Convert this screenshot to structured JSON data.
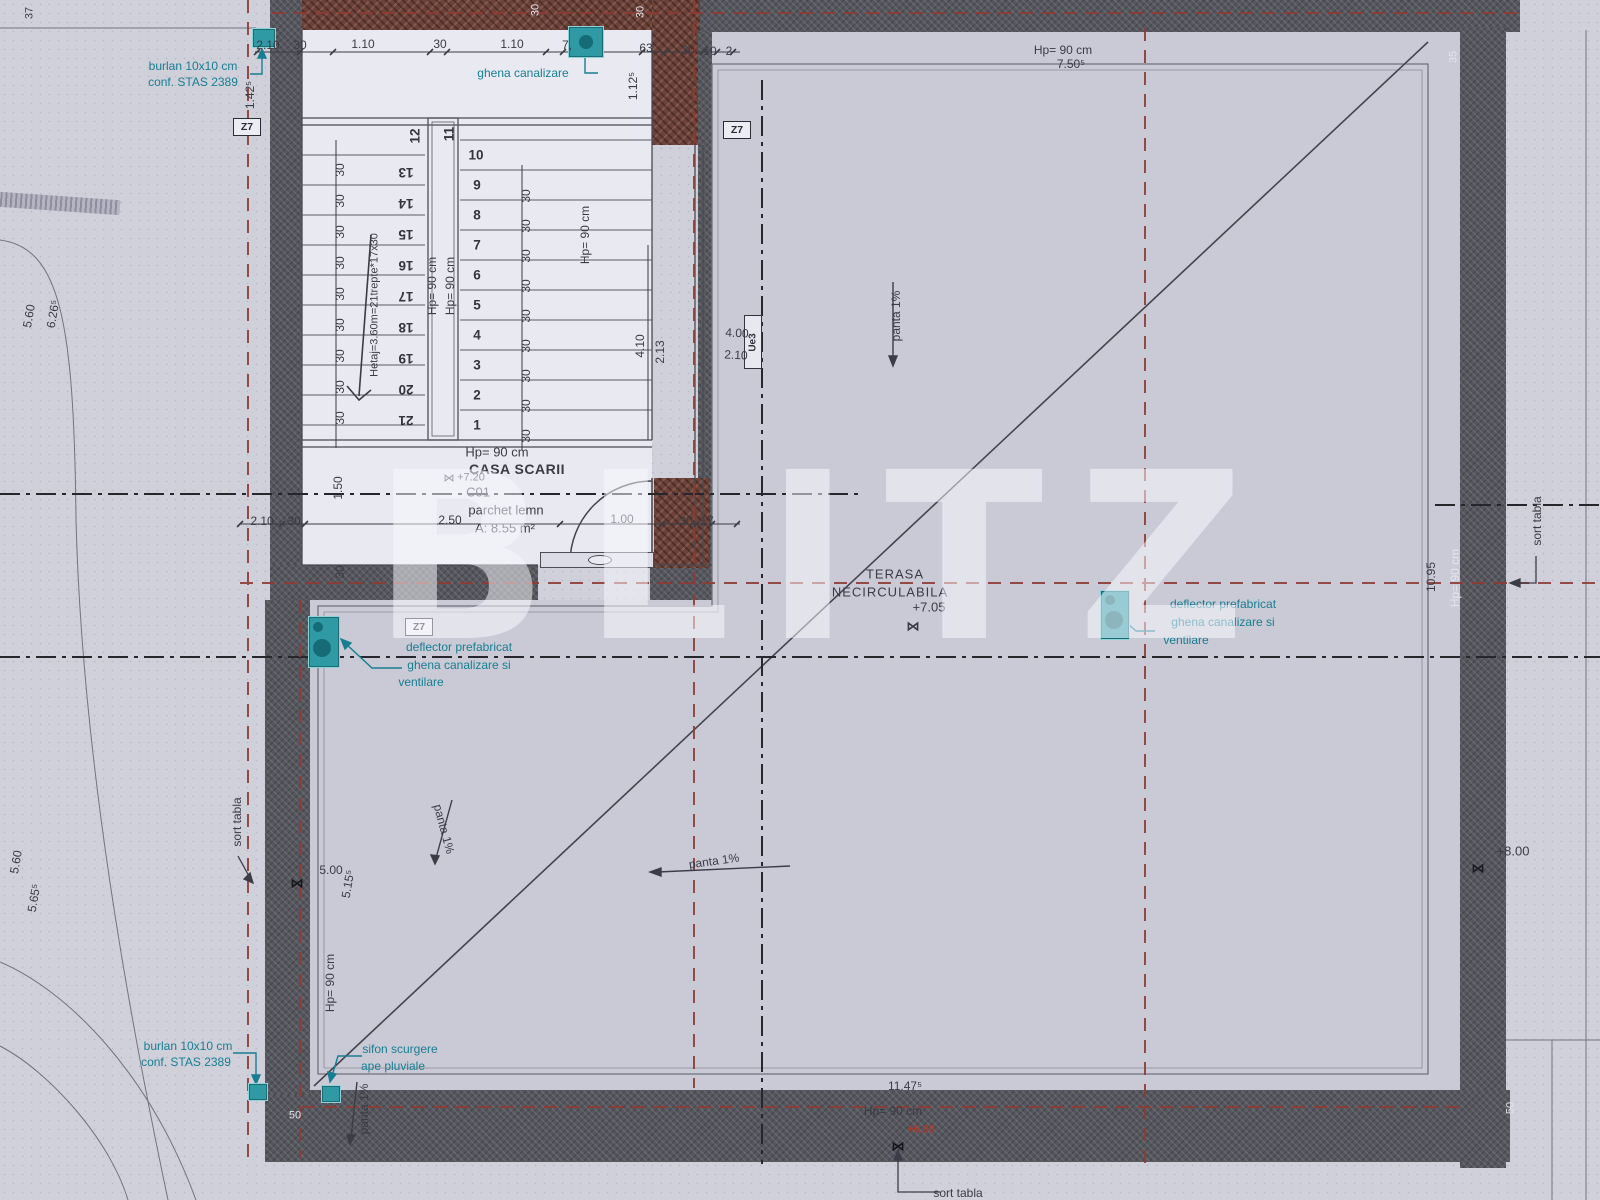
{
  "watermark": "BLITZ",
  "icons": {
    "level_marker": "⋈"
  },
  "labels": {
    "hp90": "Hp= 90 cm",
    "panta": "panta 1%",
    "sort_tabla": "sort tabla",
    "z7": "Z7",
    "ue3": "Ue3",
    "ghena": "ghena canalizare",
    "burlan_1": "burlan 10x10 cm",
    "burlan_2": "conf. STAS 2389",
    "deflector_1": "deflector prefabricat",
    "deflector_2": "ghena  canalizare si",
    "deflector_3": "ventilare",
    "sifon_1": "sifon scurgere",
    "sifon_2": "ape pluviale"
  },
  "room": {
    "name": "CASA SCARII",
    "code": "C01",
    "finish": "parchet lemn",
    "area": "A: 8.55 m²",
    "level": "+7.20"
  },
  "terrace": {
    "name_1": "TERASA",
    "name_2": "NECIRCULABILA",
    "level": "+7.05",
    "level_bottom": "+6.90",
    "level_right": "+8.00"
  },
  "stairs": {
    "formula": "Hetaj=3.60m=21trepte*17x30",
    "numbers": {
      "right": [
        "1",
        "2",
        "3",
        "4",
        "5",
        "6",
        "7",
        "8",
        "9",
        "10"
      ],
      "top": [
        "12",
        "11"
      ],
      "left": [
        "13",
        "14",
        "15",
        "16",
        "17",
        "18",
        "19",
        "20",
        "21"
      ]
    }
  },
  "dims": {
    "v30": "30",
    "top_row": [
      "2.10",
      "30",
      "1.10",
      "30",
      "1.10",
      "7,",
      "63",
      "30",
      "10",
      "2"
    ],
    "v142": "1.42⁵",
    "v112": "1.12⁵",
    "v150": "1.50",
    "bottom_left": [
      "2.10",
      "30"
    ],
    "bottom_row": [
      "2.50",
      "1.00",
      "30",
      "17"
    ],
    "v410": "4.10",
    "v213": "2.13",
    "h400": "4.00",
    "h210": "2.10",
    "terr_top": "7.50⁵",
    "terr_bottom": "11.47⁵",
    "r1095": "10.95",
    "l560a": "5.60",
    "l626": "6.26⁵",
    "l560b": "5.60",
    "l565": "5.65⁵",
    "l500": "5.00",
    "l515": "5.15⁵",
    "wall50": "50",
    "c37": "37",
    "c35": "35",
    "c50": "50"
  }
}
